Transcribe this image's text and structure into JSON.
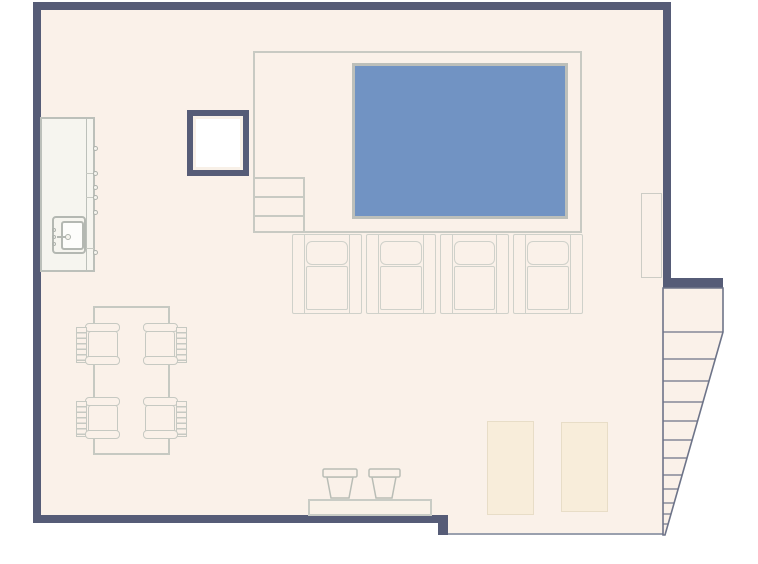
{
  "meta": {
    "type": "floor-plan",
    "description": "Open-plan loft floor plan: raised pool platform with access steps, row of four home-theater recliner seats, kitchen counter with sink, dining table with four chairs, bar bench with two stools, two floor mats, wall cabinet and a tapering staircase on the right"
  },
  "palette": {
    "wall": "#565c77",
    "floor": "#faf1e9",
    "outside": "#ffffff",
    "pool_water": "#7193c3",
    "pool_edge": "#bcbfba",
    "platform_edge": "#c8cac3",
    "furniture_line": "#c6c9c2",
    "stair_line": "#6e7489",
    "mat_fill": "#f8edda",
    "counter_fill": "#f6f5ef",
    "shaft_core": "#ffffff"
  },
  "elements": {
    "pool": {
      "label": "pool"
    },
    "platform": {
      "label": "raised-platform",
      "access_steps": 3
    },
    "staircase": {
      "label": "staircase",
      "treads": 12,
      "shape": "tapering"
    },
    "theater_seats": {
      "label": "recliner-seat-row",
      "count": 4
    },
    "dining": {
      "table": 1,
      "chairs": 4
    },
    "kitchen": {
      "counter": 1,
      "sink": 1,
      "cabinet_knobs": 6
    },
    "bar": {
      "bench": 1,
      "stools": 2
    },
    "mats": {
      "count": 2
    },
    "shaft": {
      "label": "column-shaft"
    },
    "cabinet": {
      "label": "wall-cabinet"
    }
  }
}
